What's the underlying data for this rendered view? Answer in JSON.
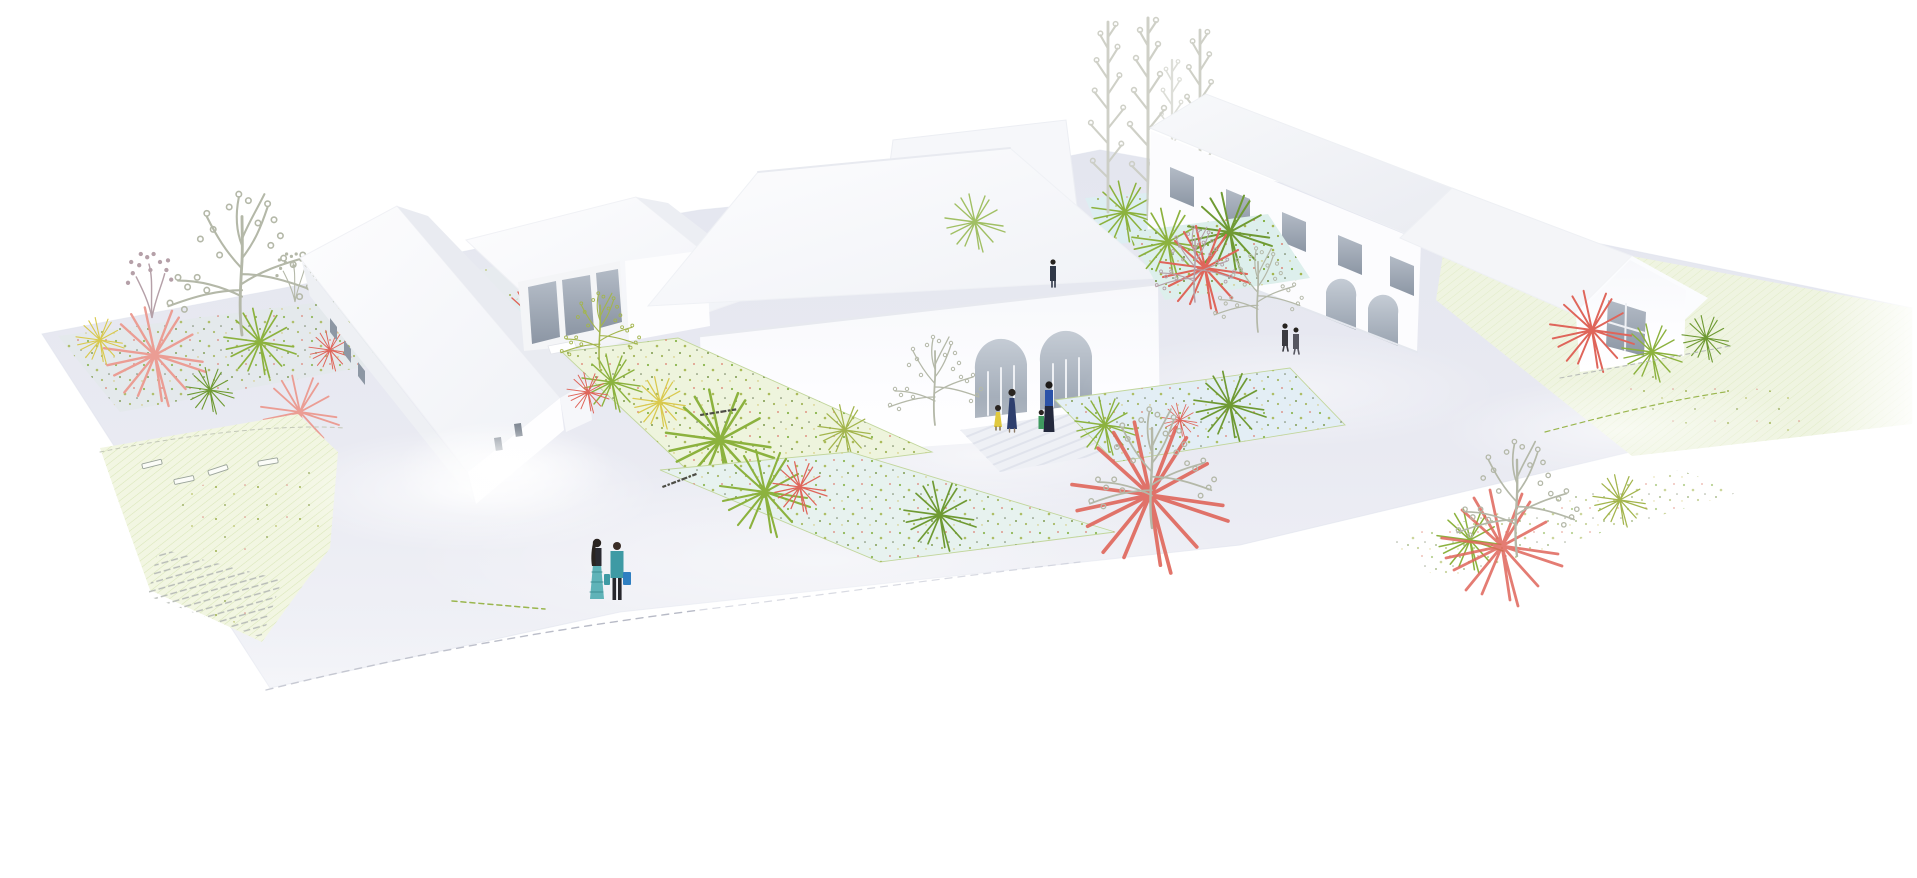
{
  "meta": {
    "title": "Aerial architectural rendering of a white courtyard building complex",
    "description": "Bird's-eye white massing-model rendering: a steep gabled house, a glazed gabled pavilion, a large central hall with two arched entries, a long two-storey wing with an arched arcade and a small gabled end house arranged around planted courtyards; hand-sketched trees, starburst shrubs in green, red, coral and yellow, hatched lawns, dashed paths and small human figures."
  },
  "palette": {
    "page_bg": "#ffffff",
    "ground": "#e8e9f1",
    "ground_light": "#f1f2f7",
    "meadow": "#f2f6e2",
    "meadow_hatch": "#d9e6b8",
    "bed_teal": "#ddefec",
    "bed_blue": "#e3eef5",
    "bed_green": "#eef4dd",
    "bed_outline": "#c2d69c",
    "roof_bright": "#fbfbfd",
    "roof_shade": "#ecedf3",
    "wall": "#ffffff",
    "wall_shade": "#f0f1f5",
    "glass": "#97a1ae",
    "glass_light": "#bcc3cd",
    "sketch": "#b4b8a8",
    "sketch_light": "#caccc2",
    "green_accent": "#8cb23e",
    "green_dark": "#6f9a33",
    "olive": "#a3b54d",
    "red_accent": "#df655a",
    "coral": "#eb9d94",
    "yellow_accent": "#d9c94e",
    "path_dash": "#b7bac6",
    "annotation_ink": "#4d4d45",
    "people_navy": "#2e3f6e",
    "people_blue": "#2b52a8",
    "people_teal": "#3e9aa4",
    "people_teal_light": "#5fb3b8",
    "people_dark": "#2b2b31",
    "people_green": "#3f9a5f",
    "people_yellow": "#e0c93f",
    "bag_blue": "#2f7fc1"
  },
  "scene": {
    "buildings": [
      {
        "id": "left-gabled-house",
        "form": "tall steep-gabled white volume with tiny window slits"
      },
      {
        "id": "mid-gabled-pavilion",
        "form": "gabled volume with a glazed facade of three grey panes"
      },
      {
        "id": "central-hall",
        "form": "large pitched roof over a facade with two arched glazed entries"
      },
      {
        "id": "rear-low-wing",
        "form": "low flat-roofed white volume behind the hall"
      },
      {
        "id": "right-long-wing",
        "form": "two-storey wing with a ribbon of upper windows and arched arcade"
      },
      {
        "id": "right-gabled-house",
        "form": "gabled end house with one upper window"
      }
    ],
    "landscape": {
      "meadow_left": "hatched lawn with planting dots, sketched benches and a striped path",
      "meadow_right": "lawn with red and green starburst shrubs and dashed walking paths",
      "planted_beds": "speckled planting beds edged in green lining the courtyards",
      "trees": "hand-sketched deciduous trees and a row of tall sketched poplars",
      "shrubs": "radial starburst shrubs in green, red, coral and yellow"
    },
    "people": [
      {
        "id": "couple-foreground-left",
        "desc": "two adults walking: teal shirt with blue bags, black top with teal patterned skirt"
      },
      {
        "id": "family-central-courtyard",
        "desc": "child in yellow, woman in navy dress, woman in blue with a toddler in green"
      },
      {
        "id": "pair-right-courtyard",
        "desc": "two figures in dark clothes walking by the arcade"
      },
      {
        "id": "figure-upper-courtyard",
        "desc": "single standing figure in dark clothes"
      }
    ],
    "annotations": [
      {
        "id": "ground-label-1",
        "text": "(illegible small plan label)"
      },
      {
        "id": "ground-label-2",
        "text": "(illegible small plan label)"
      }
    ]
  }
}
